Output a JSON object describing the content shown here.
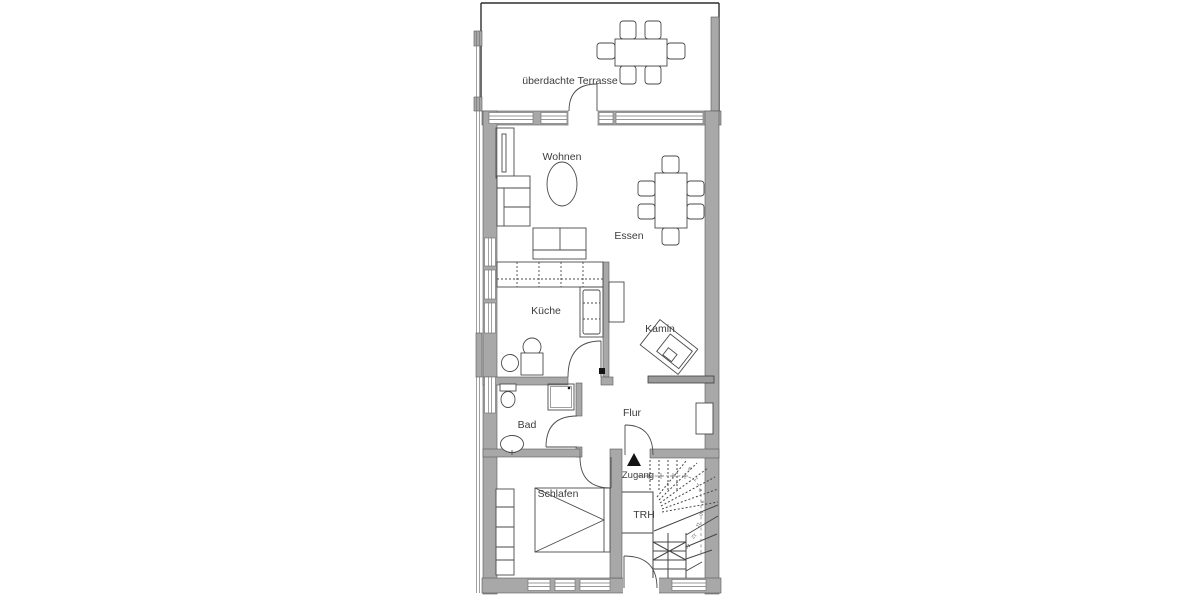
{
  "plan": {
    "type": "floor-plan",
    "language": "de",
    "labels": {
      "terrasse": "überdachte Terrasse",
      "wohnen": "Wohnen",
      "essen": "Essen",
      "kueche": "Küche",
      "kamin": "Kamin",
      "bad": "Bad",
      "flur": "Flur",
      "zugang": "Zugang",
      "schlafen": "Schlafen",
      "trh": "TRH"
    },
    "stair_step_numbers": [
      "6",
      "7",
      "8",
      "9",
      "10",
      "11",
      "12",
      "13"
    ],
    "colors": {
      "background": "#ffffff",
      "wall_fill": "#a8a8a8",
      "line": "#464646",
      "label_text": "#3c3c3c",
      "entry_arrow": "#141414"
    }
  }
}
